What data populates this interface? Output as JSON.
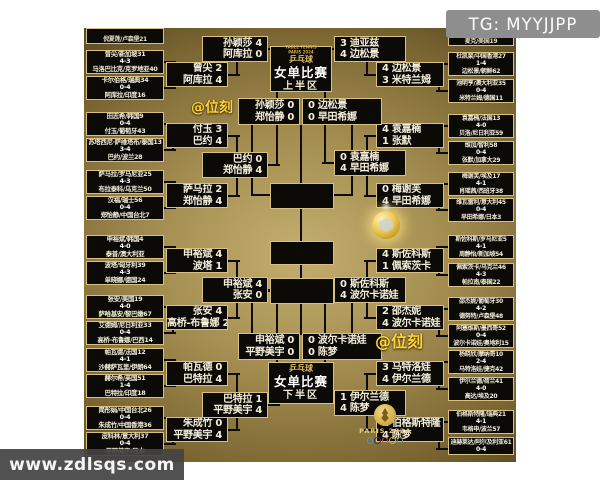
{
  "watermarks": {
    "telegram": "TG: MYYJJPP",
    "site": "www.zdlsqs.com",
    "weike_top": "@位刻",
    "weike_bottom": "@位刻"
  },
  "event": {
    "sport": "乒乓球",
    "event_name": "女单比赛",
    "top_half": "上半区",
    "bottom_half": "下半区",
    "games_small_line1": "TABLE TENNIS",
    "games_small_line2": "PARIS 2024",
    "paris_logo_text": "PARIS 2024"
  },
  "colors": {
    "box_bg": "#0b0a07",
    "box_border": "#d8c080",
    "text": "#f3edda",
    "gold_text": "#e2c164",
    "watermark_yellow": "#ffd43a",
    "tg_bg": "#8e8e8e",
    "site_bg": "#444444",
    "medal_gold": "#edc955"
  },
  "bracket": {
    "round_of_64": {
      "top_left_partial": "倪夏莲/卢森堡21",
      "top_right_partial": "麦克/美国19",
      "top_left": [
        {
          "p1": "曾尖/新加坡31",
          "score": "4-3",
          "p2": "马洛巴比克/克罗地亚40"
        },
        {
          "p1": "卡尔伯格/瑞典34",
          "score": "0-4",
          "p2": "阿库拉/印度16"
        },
        {
          "p1": "田志希/韩国9",
          "score": "0-4",
          "p2": "付玉/葡萄牙43"
        },
        {
          "p1": "苏塔西尼·萨维塔布/泰国13",
          "score": "3-4",
          "p2": "巴约/波兰28"
        },
        {
          "p1": "萨马拉/罗马尼亚25",
          "score": "4-3",
          "p2": "布拉泰科/乌克兰50"
        },
        {
          "p1": "汉福/瑞士56",
          "score": "0-4",
          "p2": "郑怡静/中国台北7"
        }
      ],
      "top_right": [
        {
          "p1": "杜凯琹/中国香港27",
          "score": "1-4",
          "p2": "边松景/朝鲜62"
        },
        {
          "p1": "池明亨/澳大利亚35",
          "score": "0-4",
          "p2": "米特兰姆/德国11"
        },
        {
          "p1": "袁嘉楠/法国13",
          "score": "4-0",
          "p2": "贝洛/尼日利亚59"
        },
        {
          "p1": "维加/智利58",
          "score": "0-4",
          "p2": "张默/加拿大29"
        },
        {
          "p1": "梅谢芙/埃及17",
          "score": "4-1",
          "p2": "肖瑶茜/西班牙38"
        },
        {
          "p1": "维瓦雷利/意大利45",
          "score": "0-4",
          "p2": "早田希娜/日本3"
        }
      ],
      "bottom_left": [
        {
          "p1": "申裕斌/韩国4",
          "score": "4-0",
          "p2": "泰普/澳大利亚"
        },
        {
          "p1": "波塔/匈牙利39",
          "score": "4-3",
          "p2": "单晓娜/德国24"
        },
        {
          "p1": "张安/美国19",
          "score": "4-0",
          "p2": "萨哈基安/黎巴嫩67"
        },
        {
          "p1": "艾德姆/尼日利亚33",
          "score": "0-4",
          "p2": "高桥-布鲁娜/巴西14"
        },
        {
          "p1": "帕瓦德/法国12",
          "score": "4-1",
          "p2": "沙赫萨瓦里/伊朗64"
        },
        {
          "p1": "赫尔希/英国51",
          "score": "1-4",
          "p2": "巴特拉/印度18"
        },
        {
          "p1": "简彤娟/中国台北26",
          "score": "0-4",
          "p2": "朱成竹/中国香港36"
        },
        {
          "p1": "皮科林/意大利37",
          "score": "0-4",
          "p2": "平野美宇/日本"
        }
      ],
      "bottom_right": [
        {
          "p1": "斯佐科斯/罗马尼亚5",
          "score": "4-1",
          "p2": "周静怡/新加坡54"
        },
        {
          "p1": "佩索茨卡/乌克兰46",
          "score": "4-3",
          "p2": "帕拉南/泰国22"
        },
        {
          "p1": "邵杰妮/葡萄牙30",
          "score": "4-2",
          "p2": "德努特/卢森堡48"
        },
        {
          "p1": "阿塞维斯/墨西哥52",
          "score": "0-4",
          "p2": "波尔卡诺娃/奥地利15"
        },
        {
          "p1": "杨晓欣/摩纳哥10",
          "score": "2-4",
          "p2": "马特洛娃/捷克42"
        },
        {
          "p1": "伊尔兰德/荷兰41",
          "score": "4-0",
          "p2": "高达/埃及20"
        },
        {
          "p1": "伯格斯特隆/瑞典21",
          "score": "4-1",
          "p2": "韦格申/波兰57"
        },
        {
          "p1": "迪赫莱达/阿尔及利亚61",
          "score": "0-4",
          "p2": ""
        }
      ]
    },
    "round_of_32": {
      "top_left": [
        {
          "p1": "曾尖",
          "s1": "2",
          "p2": "阿库拉",
          "s2": "4"
        },
        {
          "p1": "付玉",
          "s1": "3",
          "p2": "巴约",
          "s2": "4"
        },
        {
          "p1": "萨马拉",
          "s1": "2",
          "p2": "郑怡静",
          "s2": "4"
        }
      ],
      "top_right": [
        {
          "p1": "边松景",
          "s1": "4",
          "p2": "米特兰姆",
          "s2": "3"
        },
        {
          "p1": "袁嘉楠",
          "s1": "4",
          "p2": "张默",
          "s2": "1"
        },
        {
          "p1": "梅谢芙",
          "s1": "0",
          "p2": "早田希娜",
          "s2": "4"
        }
      ],
      "bottom_left": [
        {
          "p1": "申裕斌",
          "s1": "4",
          "p2": "波塔",
          "s2": "1"
        },
        {
          "p1": "张安",
          "s1": "4",
          "p2": "高桥-布鲁娜",
          "s2": "2"
        },
        {
          "p1": "帕瓦德",
          "s1": "0",
          "p2": "巴特拉",
          "s2": "4"
        },
        {
          "p1": "朱成竹",
          "s1": "0",
          "p2": "平野美宇",
          "s2": "4"
        }
      ],
      "bottom_right": [
        {
          "p1": "斯佐科斯",
          "s1": "4",
          "p2": "佩索茨卡",
          "s2": "1"
        },
        {
          "p1": "邵杰妮",
          "s1": "2",
          "p2": "波尔卡诺娃",
          "s2": "4"
        },
        {
          "p1": "马特洛娃",
          "s1": "3",
          "p2": "伊尔兰德",
          "s2": "4"
        },
        {
          "p1": "伯格斯特隆",
          "s1": "1",
          "p2": "陈梦",
          "s2": "4"
        }
      ]
    },
    "round_of_16": {
      "top_left": [
        {
          "p1": "孙颖莎",
          "s1": "4",
          "p2": "阿库拉",
          "s2": "0"
        },
        {
          "p1": "巴约",
          "s1": "0",
          "p2": "郑怡静",
          "s2": "4"
        }
      ],
      "top_right": [
        {
          "p1": "迪亚兹",
          "s1": "3",
          "p2": "边松景",
          "s2": "4"
        },
        {
          "p1": "袁嘉楠",
          "s1": "0",
          "p2": "早田希娜",
          "s2": "4"
        }
      ],
      "bottom_left": [
        {
          "p1": "申裕斌",
          "s1": "4",
          "p2": "张安",
          "s2": "0"
        },
        {
          "p1": "巴特拉",
          "s1": "1",
          "p2": "平野美宇",
          "s2": "4"
        }
      ],
      "bottom_right": [
        {
          "p1": "斯佐科斯",
          "s1": "0",
          "p2": "波尔卡诺娃",
          "s2": "4"
        },
        {
          "p1": "伊尔兰德",
          "s1": "1",
          "p2": "陈梦",
          "s2": "4"
        }
      ]
    },
    "quarterfinals": {
      "top_left": {
        "p1": "孙颖莎",
        "s1": "0",
        "p2": "郑怡静",
        "s2": "0"
      },
      "top_right": {
        "p1": "边松景",
        "s1": "0",
        "p2": "早田希娜",
        "s2": "0"
      },
      "bottom_left": {
        "p1": "申裕斌",
        "s1": "0",
        "p2": "平野美宇",
        "s2": "0"
      },
      "bottom_right": {
        "p1": "波尔卡诺娃",
        "s1": "0",
        "p2": "陈梦",
        "s2": "0"
      }
    }
  }
}
